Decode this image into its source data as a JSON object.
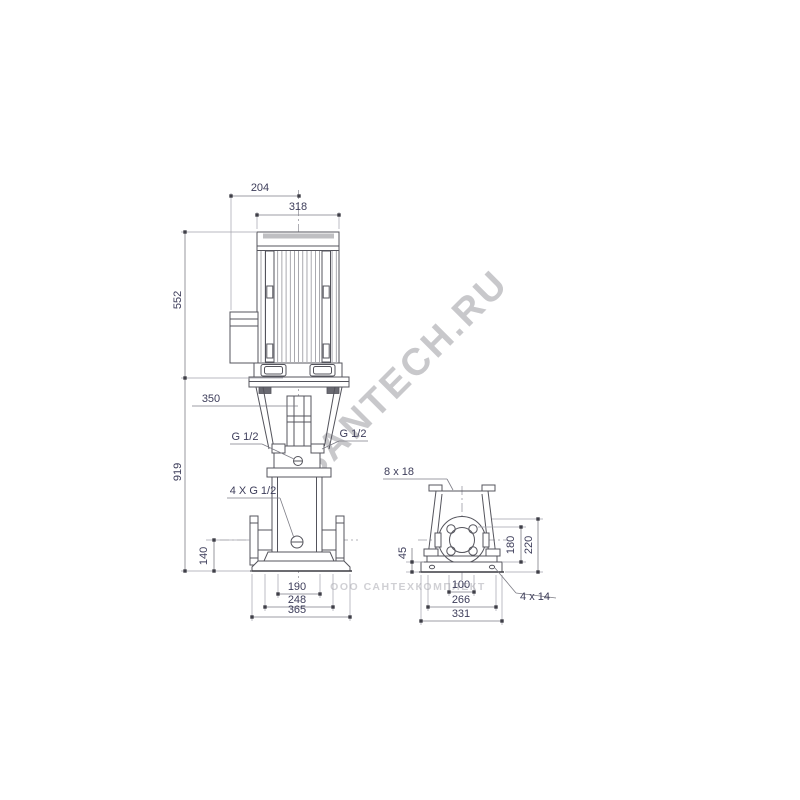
{
  "colors": {
    "background": "#ffffff",
    "object_line": "#54545c",
    "dimension_line": "#7d7d86",
    "dimension_text": "#3d3d5a",
    "watermark": "#9c9ca2"
  },
  "front_view": {
    "name": "pump front elevation",
    "dims": {
      "d204": "204",
      "d318": "318",
      "d552": "552",
      "d350": "350",
      "d919": "919",
      "d140": "140",
      "d190": "190",
      "d248": "248",
      "d365": "365",
      "port_left": "G 1/2",
      "port_right": "G 1/2",
      "drain_ports": "4 X G 1/2"
    }
  },
  "side_view": {
    "name": "pump end elevation",
    "dims": {
      "slots": "8 x 18",
      "d45": "45",
      "d180": "180",
      "d220": "220",
      "d100": "100",
      "d266": "266",
      "d331": "331",
      "holes": "4 x 14"
    }
  },
  "watermark": {
    "main": "SANTECH.RU",
    "company": "ООО САНТЕХКОМПЛЕКТ"
  }
}
